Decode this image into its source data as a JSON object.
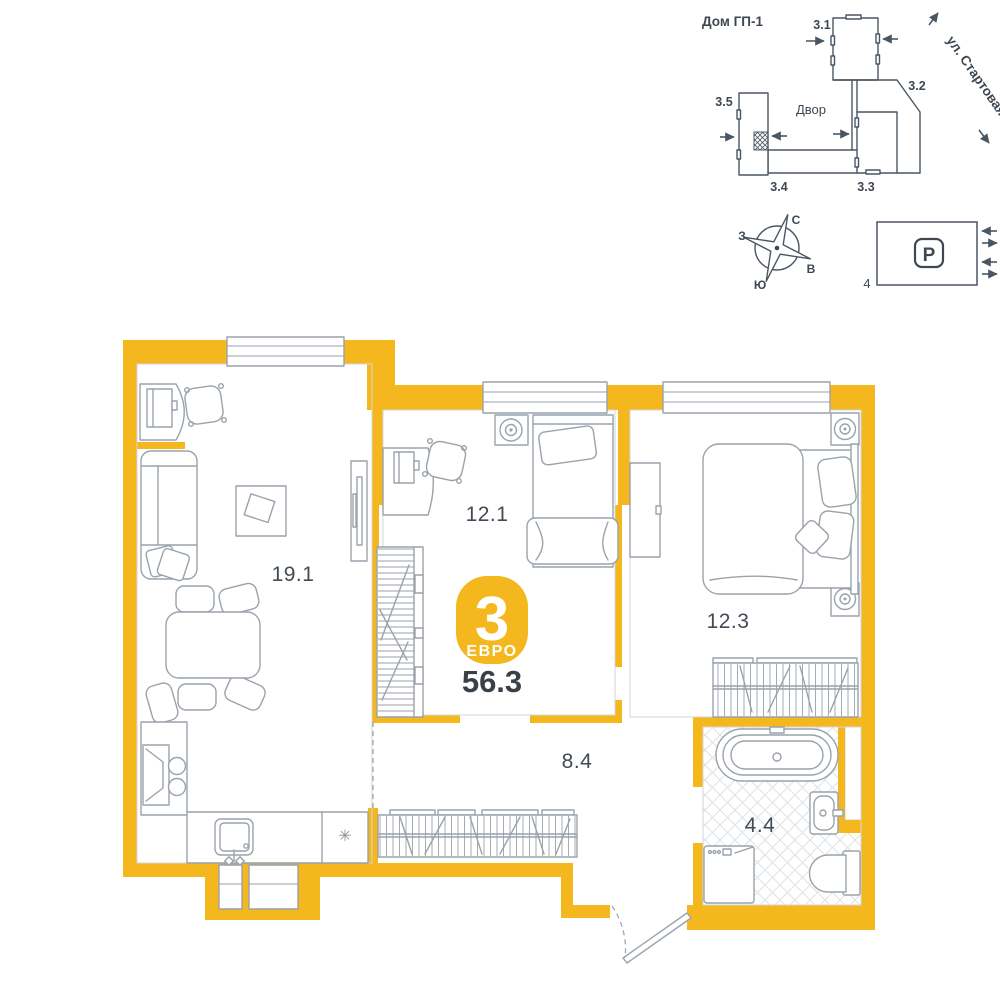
{
  "site_plan": {
    "house_label": "Дом ГП-1",
    "courtyard_label": "Двор",
    "street_label": "ул. Стартовая",
    "building_labels": [
      "3.1",
      "3.2",
      "3.3",
      "3.4",
      "3.5"
    ]
  },
  "compass": {
    "north": "С",
    "east": "В",
    "south": "Ю",
    "west": "З"
  },
  "parking": {
    "symbol": "P",
    "lot_number": "4"
  },
  "apartment": {
    "badge": {
      "rooms_count": "3",
      "layout_type": "ЕВРО"
    },
    "total_area": "56.3",
    "rooms": [
      {
        "id": "living-kitchen",
        "area": "19.1"
      },
      {
        "id": "bedroom-1",
        "area": "12.1"
      },
      {
        "id": "bedroom-2",
        "area": "12.3"
      },
      {
        "id": "hallway",
        "area": "8.4"
      },
      {
        "id": "bathroom",
        "area": "4.4"
      }
    ],
    "fridge_symbol": "✳"
  },
  "colors": {
    "walls_accent": "#F5B71E",
    "furniture_line": "#9AA2AB",
    "site_line": "#4A5663",
    "label_text": "#414B55",
    "total_text": "#394048",
    "tile_line": "#DEE2E5"
  }
}
